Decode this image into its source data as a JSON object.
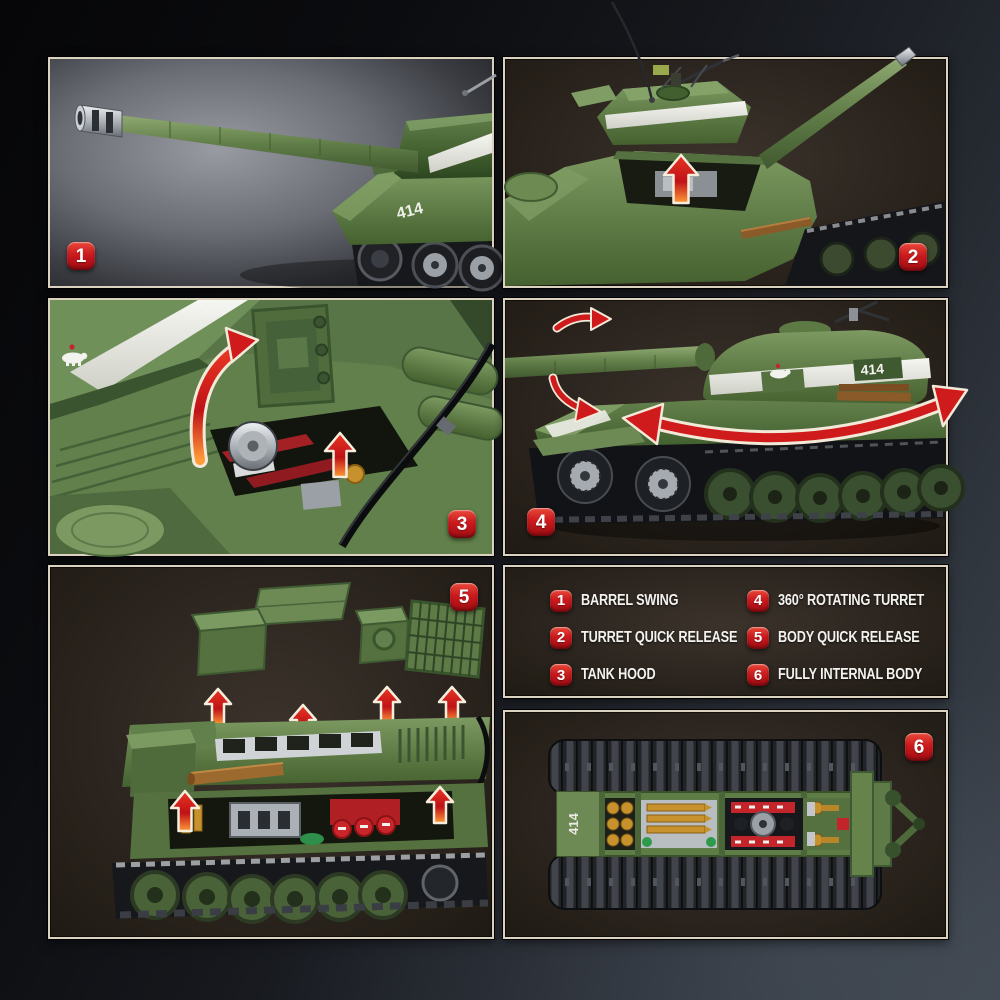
{
  "legend": {
    "items": [
      {
        "num": "1",
        "label": "BARREL SWING"
      },
      {
        "num": "2",
        "label": "TURRET QUICK RELEASE"
      },
      {
        "num": "3",
        "label": "TANK HOOD"
      },
      {
        "num": "4",
        "label": "360° ROTATING TURRET"
      },
      {
        "num": "5",
        "label": "BODY QUICK RELEASE"
      },
      {
        "num": "6",
        "label": "FULLY INTERNAL BODY"
      }
    ]
  },
  "panels": {
    "p1": {
      "badge": "1"
    },
    "p2": {
      "badge": "2"
    },
    "p3": {
      "badge": "3"
    },
    "p4": {
      "badge": "4"
    },
    "p5": {
      "badge": "5"
    },
    "p6": {
      "badge": "6"
    }
  },
  "markings": {
    "turret_number": "414"
  },
  "colors": {
    "accent_red": "#c9161d",
    "arrow_red": "#d11f1d",
    "panel_border": "#dcd2c0",
    "panel_brown": "#2d2620",
    "tank_green": "#62804a",
    "stripe_white": "#f2f2ee",
    "backdrop_gray": "#83868c",
    "track_dark": "#141518"
  }
}
